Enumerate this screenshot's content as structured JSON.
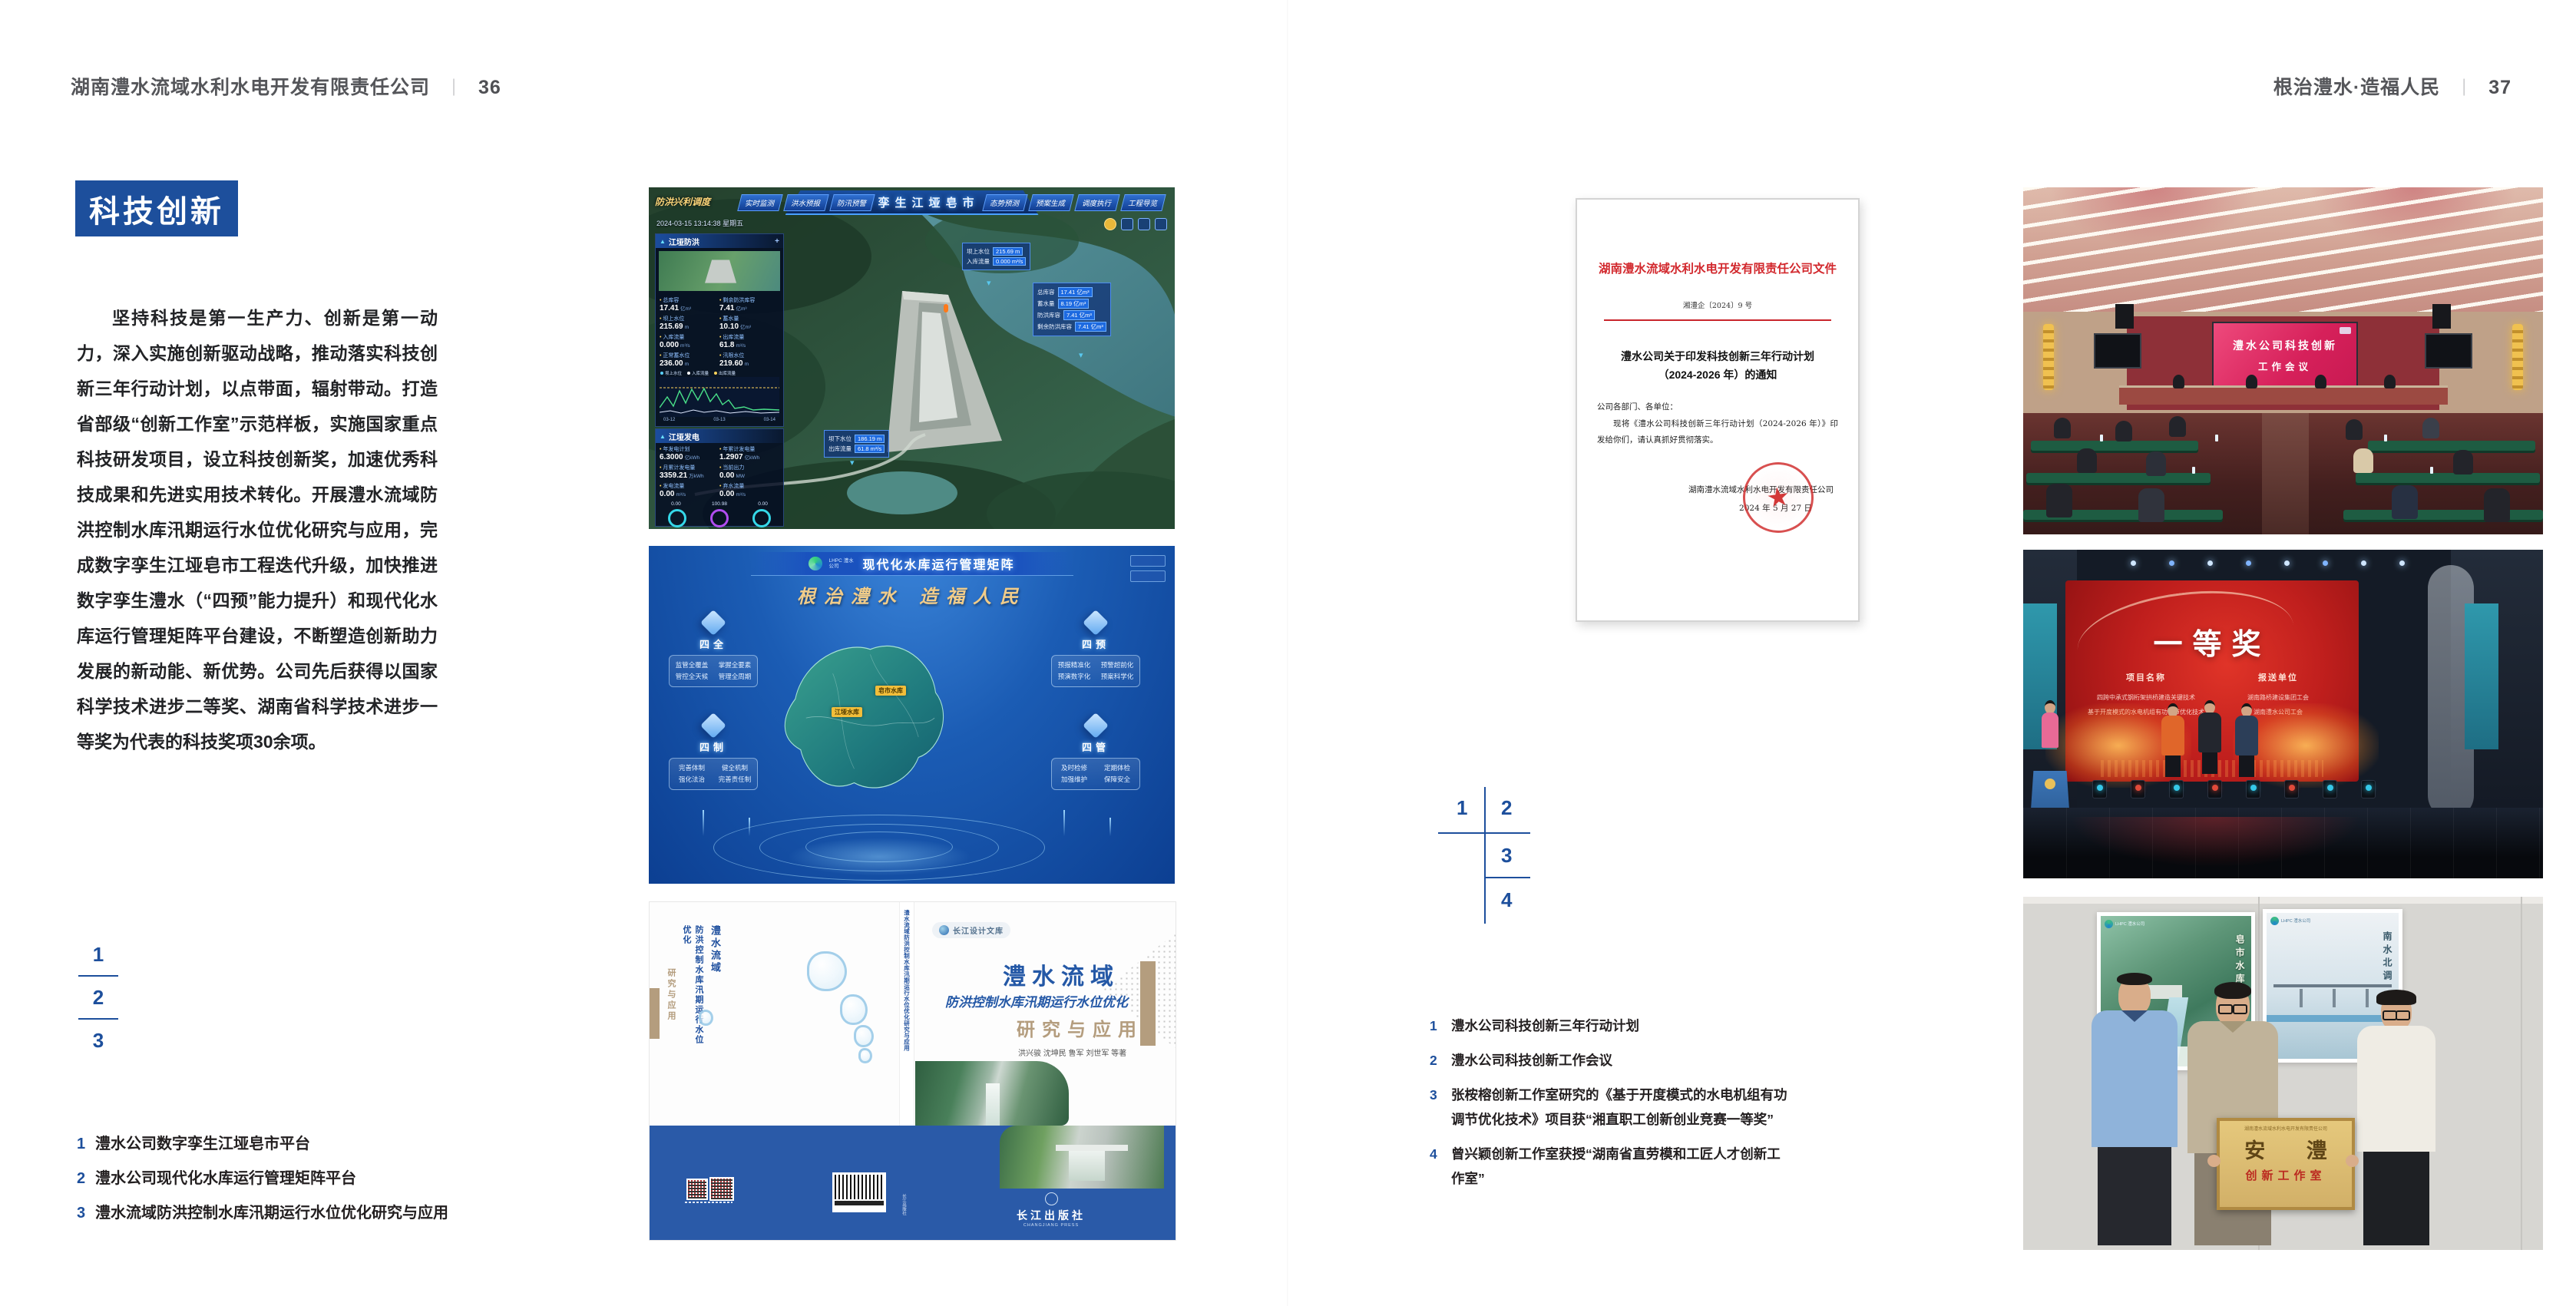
{
  "colors": {
    "accent_blue": "#1d4f9c",
    "doc_red": "#d2282d",
    "band_blue": "#2a5aa8",
    "gold": "#f0cc8a"
  },
  "left_page": {
    "header": {
      "company": "湖南澧水流域水利水电开发有限责任公司",
      "separator": "｜",
      "page_number": "36"
    },
    "section_title": "科技创新",
    "paragraph": "坚持科技是第一生产力、创新是第一动力，深入实施创新驱动战略，推动落实科技创新三年行动计划，以点带面，辐射带动。打造省部级“创新工作室”示范样板，实施国家重点科技研发项目，设立科技创新奖，加速优秀科技成果和先进实用技术转化。开展澧水流域防洪控制水库汛期运行水位优化研究与应用，完成数字孪生江垭皂市工程迭代升级，加快推进数字孪生澧水（“四预”能力提升）和现代化水库运行管理矩阵平台建设，不断塑造创新助力发展的新动能、新优势。公司先后获得以国家科学技术进步二等奖、湖南省科学技术进步一等奖为代表的科技奖项30余项。",
    "figure_markers": [
      "1",
      "2",
      "3"
    ],
    "captions": [
      {
        "no": "1",
        "text": "澧水公司数字孪生江垭皂市平台"
      },
      {
        "no": "2",
        "text": "澧水公司现代化水库运行管理矩阵平台"
      },
      {
        "no": "3",
        "text": "澧水流域防洪控制水库汛期运行水位优化研究与应用"
      }
    ],
    "fig_dashboard": {
      "title": "数字孪生江垭皂市",
      "corner_label": "防洪兴利调度",
      "tabs_left": [
        "实时监测",
        "洪水预报",
        "防汛预警"
      ],
      "tabs_right": [
        "态势预测",
        "预案生成",
        "调度执行",
        "工程导览"
      ],
      "timestamp": "2024-03-15 13:14:38 星期五",
      "panel_flood": {
        "title": "江垭防洪",
        "stats": [
          {
            "label": "总库容",
            "value": "17.41",
            "unit": "亿m³"
          },
          {
            "label": "剩余防洪库容",
            "value": "7.41",
            "unit": "亿m³"
          },
          {
            "label": "坝上水位",
            "value": "215.69",
            "unit": "m"
          },
          {
            "label": "蓄水量",
            "value": "10.10",
            "unit": "亿m³"
          },
          {
            "label": "入库流量",
            "value": "0.000",
            "unit": "m³/s"
          },
          {
            "label": "出库流量",
            "value": "61.8",
            "unit": "m³/s"
          },
          {
            "label": "正常蓄水位",
            "value": "236.00",
            "unit": "m"
          },
          {
            "label": "汛限水位",
            "value": "219.60",
            "unit": "m"
          }
        ],
        "legend": [
          "坝上水位",
          "入库流量",
          "出库流量"
        ],
        "chart_x": [
          "03-12",
          "03-13",
          "03-14"
        ]
      },
      "panel_power": {
        "title": "江垭发电",
        "stats": [
          {
            "label": "年发电计划",
            "value": "6.3000",
            "unit": "亿kWh"
          },
          {
            "label": "年累计发电量",
            "value": "1.2907",
            "unit": "亿kWh"
          },
          {
            "label": "月累计发电量",
            "value": "3359.21",
            "unit": "万kWh"
          },
          {
            "label": "当前出力",
            "value": "0.00",
            "unit": "MW"
          },
          {
            "label": "发电流量",
            "value": "0.00",
            "unit": "m³/s"
          },
          {
            "label": "弃水流量",
            "value": "0.00",
            "unit": "m³/s"
          }
        ],
        "gauge_values": [
          "0.00",
          "100.98",
          "0.00"
        ]
      },
      "tooltip_up": [
        {
          "label": "坝上水位",
          "value": "215.69 m"
        },
        {
          "label": "入库流量",
          "value": "0.000 m³/s"
        }
      ],
      "tooltip_right": [
        {
          "label": "总库容",
          "value": "17.41 亿m³"
        },
        {
          "label": "蓄水量",
          "value": "8.19 亿m³"
        },
        {
          "label": "防洪库容",
          "value": "7.41 亿m³"
        },
        {
          "label": "剩余防洪库容",
          "value": "7.41 亿m³"
        }
      ],
      "tooltip_down": [
        {
          "label": "坝下水位",
          "value": "186.19 m"
        },
        {
          "label": "出库流量",
          "value": "61.8 m³/s"
        }
      ]
    },
    "fig_matrix": {
      "logo_text": "LHPC 澧水公司",
      "title": "现代化水库运行管理矩阵",
      "slogan": "根治澧水 造福人民",
      "panels": [
        {
          "title": "四全",
          "items": [
            "监管全覆盖",
            "掌握全要素",
            "管控全天候",
            "管理全周期"
          ]
        },
        {
          "title": "四预",
          "items": [
            "预报精准化",
            "预警超前化",
            "预演数字化",
            "预案科学化"
          ]
        },
        {
          "title": "四制",
          "items": [
            "完善体制",
            "健全机制",
            "强化法治",
            "完善责任制"
          ]
        },
        {
          "title": "四管",
          "items": [
            "及时检修",
            "定期体检",
            "加强维护",
            "保障安全"
          ]
        }
      ],
      "map_labels": [
        "皂市水库",
        "江垭水库"
      ]
    },
    "fig_book": {
      "imprint": "长江设计文库",
      "title_main": "澧水流域",
      "title_sub": "防洪控制水库汛期运行水位优化",
      "title_accent": "研究与应用",
      "authors": "洪兴骏  沈坤民  鲁军  刘世军  等著",
      "spine_title": "澧水流域防洪控制水库汛期运行水位优化研究与应用",
      "spine_authors": "洪兴骏 沈坤民 鲁军 刘世军 等著",
      "back_title_1": "澧水流域",
      "back_title_2": "防洪控制水库汛期运行水位优化",
      "back_title_3": "研究与应用",
      "publisher": "长江出版社",
      "publisher_en": "CHANGJIANG PRESS"
    }
  },
  "right_page": {
    "header": {
      "slogan": "根治澧水·造福人民",
      "separator": "｜",
      "page_number": "37"
    },
    "figure_markers": [
      "1",
      "2",
      "3",
      "4"
    ],
    "captions": [
      {
        "no": "1",
        "text": "澧水公司科技创新三年行动计划"
      },
      {
        "no": "2",
        "text": "澧水公司科技创新工作会议"
      },
      {
        "no": "3",
        "text": "张桉榕创新工作室研究的《基于开度模式的水电机组有功调节优化技术》项目获“湘直职工创新创业竞赛一等奖”"
      },
      {
        "no": "4",
        "text": "曾兴颖创新工作室获授“湖南省直劳模和工匠人才创新工作室”"
      }
    ],
    "fig_document": {
      "header": "湖南澧水流域水利水电开发有限责任公司文件",
      "doc_no": "湘澧企〔2024〕9 号",
      "title_line1": "澧水公司关于印发科技创新三年行动计划",
      "title_line2": "（2024-2026 年）的通知",
      "salutation": "公司各部门、各单位：",
      "body": "现将《澧水公司科技创新三年行动计划（2024-2026 年）》印发给你们，请认真抓好贯彻落实。",
      "signer": "湖南澧水流域水利水电开发有限责任公司",
      "date": "2024 年 5 月 27 日"
    },
    "fig_meeting": {
      "screen_line1": "澧水公司科技创新",
      "screen_line2": "工作会议"
    },
    "fig_award": {
      "screen_title": "一等奖",
      "col_project_head": "项目名称",
      "col_unit_head": "报送单位",
      "projects": [
        "四跨中承式钢桁架拱桥建造关键技术",
        "基于开度模式的水电机组有功调节优化技术"
      ],
      "units": [
        "湖南路桥建设集团工会",
        "湖南澧水公司工会"
      ]
    },
    "fig_plaque": {
      "plaque_header": "湖南澧水流域水利水电开发有限责任公司",
      "plaque_title": "安 澧",
      "plaque_sub": "创新工作室",
      "poster_left_label": "皂市水库",
      "poster_right_label": "南水北调",
      "poster_logo": "LHPC 澧水公司"
    }
  }
}
